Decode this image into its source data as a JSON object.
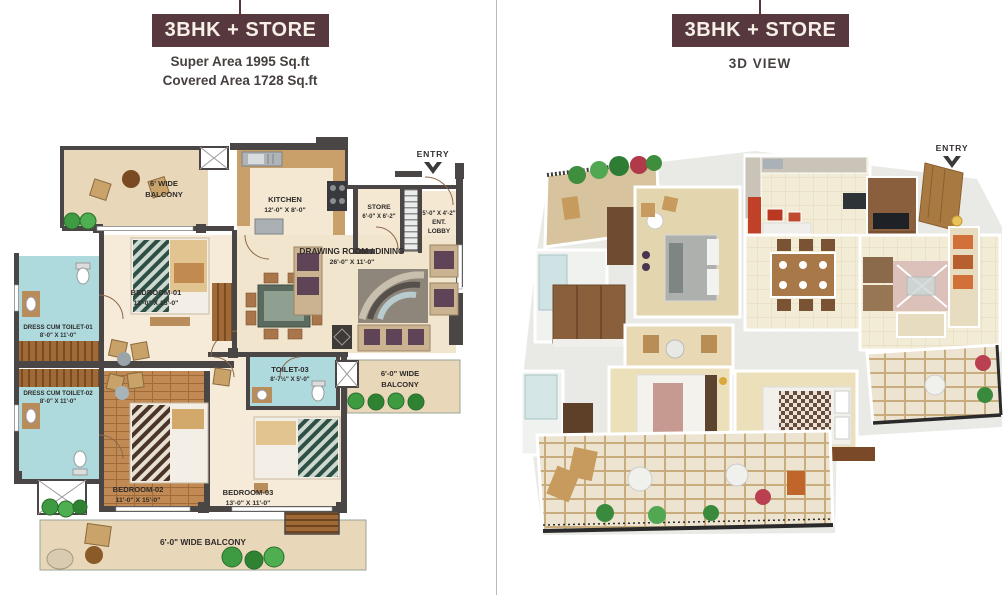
{
  "header_left": {
    "title": "3BHK + STORE",
    "subtitle1": "Super Area 1995 Sq.ft",
    "subtitle2": "Covered Area 1728 Sq.ft"
  },
  "header_right": {
    "title": "3BHK + STORE",
    "subtitle": "3D VIEW"
  },
  "colors": {
    "accent": "#57383f",
    "wall": "#4b4646",
    "floor_tile": "#f2e5cd",
    "floor_pale": "#f6ebd9",
    "wood": "#c18a55",
    "toilet_blue": "#aedade",
    "balcony": "#e9d7ba",
    "plant_green": "#3f9b41"
  },
  "plan2d": {
    "entry": "ENTRY",
    "rooms": {
      "balcony_top": {
        "l1": "6' WIDE",
        "l2": "BALCONY"
      },
      "kitchen": {
        "name": "KITCHEN",
        "dims": "12'-0\" X 8'-0\""
      },
      "store": {
        "name": "STORE",
        "dims": "6'-0\" X 6'-2\""
      },
      "ent_lobby": {
        "dims": "5'-0\" X 4'-2\"",
        "l1": "ENT.",
        "l2": "LOBBY"
      },
      "drawing": {
        "name": "DRAWING ROOM / DINING",
        "dims": "26'-0\" X 11'-0\""
      },
      "bedroom1": {
        "name": "BEDROOM-01",
        "dims": "11'-0\" X 15'-0\""
      },
      "dct1": {
        "name": "DRESS CUM TOILET-01",
        "dims": "8'-0\" X 11'-0\""
      },
      "dct2": {
        "name": "DRESS CUM TOILET-02",
        "dims": "8'-0\" X 11'-0\""
      },
      "bedroom2": {
        "name": "BEDROOM-02",
        "dims": "11'-0\" X 15'-0\""
      },
      "toilet3": {
        "name": "TOILET-03",
        "dims": "8'-7½\" X 5'-0\""
      },
      "bedroom3": {
        "name": "BEDROOM-03",
        "dims": "13'-0\" X 11'-0\""
      },
      "balcony_right": {
        "l1": "6'-0\" WIDE",
        "l2": "BALCONY"
      },
      "balcony_bottom": {
        "l1": "6'-0\" WIDE BALCONY"
      }
    }
  },
  "view3d": {
    "entry": "ENTRY"
  }
}
